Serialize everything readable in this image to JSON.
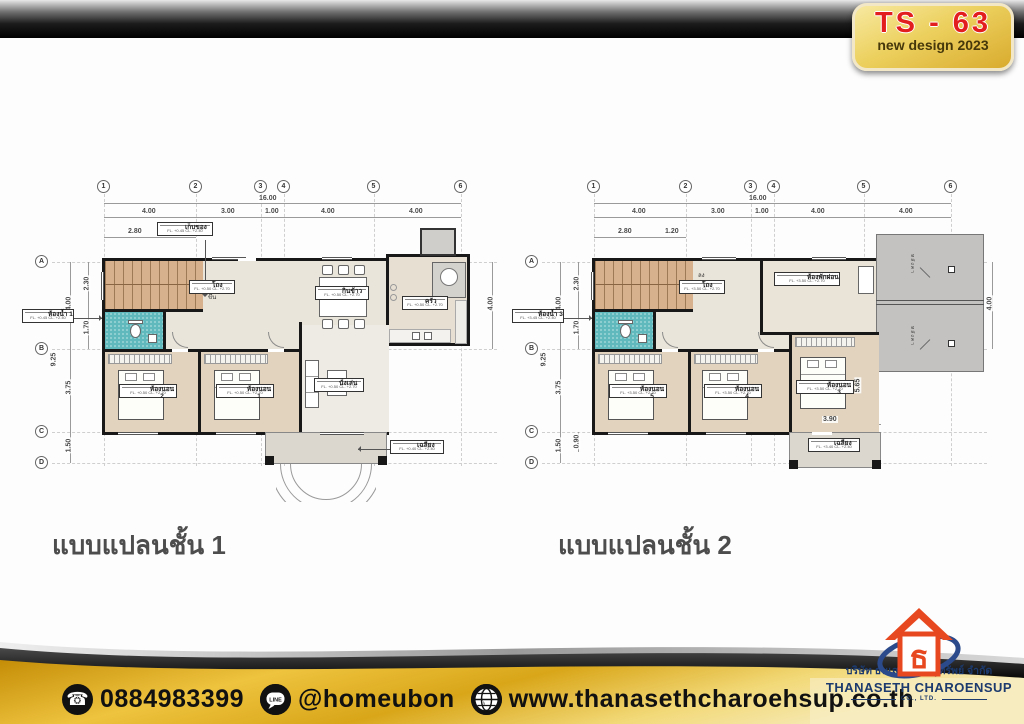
{
  "badge": {
    "code": "TS - 63",
    "subtitle": "new design 2023"
  },
  "plans": [
    {
      "title": "แบบแปลนชั้น 1",
      "grid_cols": [
        "1",
        "2",
        "3",
        "4",
        "5",
        "6"
      ],
      "grid_rows": [
        "A",
        "B",
        "C",
        "D"
      ],
      "dim_total_w": "16.00",
      "dim_cols": [
        "4.00",
        "3.00",
        "1.00",
        "4.00",
        "4.00"
      ],
      "dim_sub_top": [
        "2.80",
        "1.20"
      ],
      "dim_total_h": "9.25",
      "dim_rows": [
        "4.00",
        "3.75",
        "1.50"
      ],
      "dim_sub_left": [
        "2.30",
        "1.70"
      ],
      "dim_right": "4.00",
      "stair_note": "ขึ้น",
      "rooms": {
        "storage": {
          "name": "เก็บของ",
          "sub": "FL. +0.45 CL. +2.40"
        },
        "hall": {
          "name": "โถง",
          "sub": "FL. +0.50 CL. +2.70"
        },
        "dining": {
          "name": "กินข้าว",
          "sub": "FL. +0.50 CL. +2.70"
        },
        "kitchen": {
          "name": "ครัว",
          "sub": "FL. +0.50 CL. +2.70"
        },
        "bath": {
          "name": "ห้องน้ำ 1",
          "sub": "FL. +0.45 CL. +2.40"
        },
        "bed_a": {
          "name": "ห้องนอน 2",
          "sub": "FL. +0.50 CL. +2.70"
        },
        "bed_b": {
          "name": "ห้องนอน 1",
          "sub": "FL. +0.50 CL. +2.70"
        },
        "living": {
          "name": "นั่งเล่น",
          "sub": "FL. +0.50 CL. +2.70"
        },
        "porch": {
          "name": "เฉลียง",
          "sub": "FL. +0.40 CL. +2.40"
        }
      }
    },
    {
      "title": "แบบแปลนชั้น 2",
      "grid_cols": [
        "1",
        "2",
        "3",
        "4",
        "5",
        "6"
      ],
      "grid_rows": [
        "A",
        "B",
        "C",
        "D"
      ],
      "dim_total_w": "16.00",
      "dim_cols": [
        "4.00",
        "3.00",
        "1.00",
        "4.00",
        "4.00"
      ],
      "dim_sub_top": [
        "2.80",
        "1.20"
      ],
      "dim_total_h": "9.25",
      "dim_rows": [
        "4.00",
        "3.75",
        "1.50"
      ],
      "dim_sub_left": [
        "2.30",
        "1.70"
      ],
      "dim_sub_bottom": "0.90",
      "dim_roof": "4.00",
      "dim_balcony_w": "3.90",
      "dim_bed_h": "5.65",
      "stair_note": "ลง",
      "rooms": {
        "hall": {
          "name": "โถง",
          "sub": "FL. +3.50 CL. +2.70"
        },
        "lounge": {
          "name": "ห้องพักผ่อน",
          "sub": "FL. +3.50 CL. +2.70"
        },
        "bath": {
          "name": "ห้องน้ำ 3",
          "sub": "FL. +3.45 CL. +2.40"
        },
        "bed_a": {
          "name": "ห้องนอน 5",
          "sub": "FL. +3.50 CL. +2.70"
        },
        "bed_b": {
          "name": "ห้องนอน 4",
          "sub": "FL. +3.50 CL. +2.70"
        },
        "bed_c": {
          "name": "ห้องนอน 3",
          "sub": "FL. +3.50 CL. +2.70"
        },
        "balcony": {
          "name": "เฉลียง",
          "sub": "FL. +3.40 CL. +2.40"
        },
        "roof": "หลังคา"
      }
    }
  ],
  "footer": {
    "phone": "0884983399",
    "phone_glyph": "☎",
    "line_id": "@homeubon",
    "line_glyph": "LINE",
    "website": "www.thanasethcharoehsup.co.th",
    "company_th": "บริษัท ธนเสฏฐ์ เจริญทรัพย์ จำกัด",
    "company_en": "THANASETH CHAROENSUP",
    "company_co": "CO., LTD.",
    "icons": [
      "phone-icon",
      "line-app-icon",
      "globe-icon"
    ]
  },
  "colors": {
    "gold": "#e6b93c",
    "badge_red": "#e31e1e",
    "navy": "#1c3a6e",
    "logo_red": "#e8481f"
  }
}
